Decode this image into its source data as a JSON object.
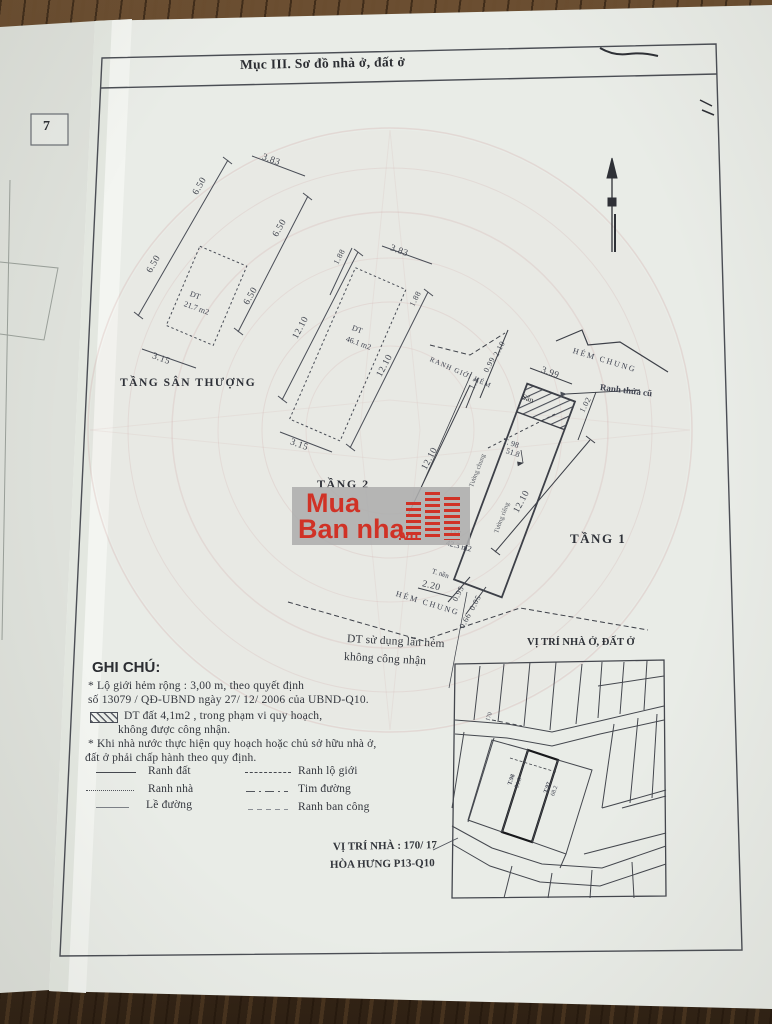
{
  "header": {
    "title": "Mục III. Sơ đồ nhà ở, đất ở"
  },
  "tab": {
    "label": "7"
  },
  "roof": {
    "name": "TẦNG SÂN THƯỢNG",
    "area_label": "DT",
    "area_value": "21.7 m2",
    "dims": {
      "top": "3.83",
      "bottom": "3.15",
      "side": "6.50"
    }
  },
  "floor2": {
    "name": "TẦNG 2",
    "area_label": "DT",
    "area_value": "46.1 m2",
    "dims": {
      "top": "3.83",
      "bottom": "3.15",
      "side": "12.10",
      "small": "1.88"
    }
  },
  "floor1": {
    "name": "TẦNG 1",
    "area_label": "DT",
    "area_value": "42.3 m2",
    "san": "Sân",
    "point_id": "T. 98",
    "point_area": "51.8",
    "dims": {
      "top": "3.99",
      "tl_a": "2.10",
      "tl_b": "0.99",
      "left_short": "1.3",
      "right_short": "1.02",
      "side": "12.10",
      "b_a": "2.20",
      "b_b": "0.95",
      "b_c": "0.05",
      "b_d": "0.66"
    },
    "labels": {
      "hem_chung_top": "HẺM CHUNG",
      "ranh_thua_cu": "Ranh thửa cũ",
      "ranh_gioi_hem": "RANH GIỚI HẺM",
      "tuong_chung": "Tường chung",
      "tuong_rieng": "Tường riêng",
      "t_nen": "T. nền",
      "hem_chung_bottom": "HẺM CHUNG",
      "note_line1": "DT sử dụng lấn hẻm",
      "note_line2": "không công nhận"
    }
  },
  "watermark": {
    "line1": "Mua",
    "line2": "Ban nha",
    "vn": ".vn"
  },
  "notes": {
    "title": "GHI CHÚ:",
    "lines": [
      "* Lộ giới hẻm rộng : 3,00 m, theo quyết định",
      "số 13079 / QĐ-UBND ngày 27/ 12/ 2006 của UBND-Q10.",
      "DT đất 4,1m2 , trong phạm vi quy hoạch,",
      "không được công nhận.",
      "* Khi nhà nước thực hiện quy hoạch hoặc chủ sở hữu nhà ở,",
      "đất ở phải chấp hành theo quy định."
    ]
  },
  "legend": {
    "items": [
      {
        "label": "Ranh đất"
      },
      {
        "label": "Ranh lộ giới"
      },
      {
        "label": "Ranh nhà"
      },
      {
        "label": "Tim đường"
      },
      {
        "label": "Lề đường"
      },
      {
        "label": "Ranh ban công"
      }
    ]
  },
  "map": {
    "title": "VỊ TRÍ NHÀ Ở, ĐẤT Ở",
    "street_no": "170",
    "p1_id": "T.98",
    "p1_area": "51.8",
    "p2_id": "T.97",
    "p2_area": "68.2"
  },
  "address": {
    "line1": "VỊ TRÍ NHÀ : 170/ 17",
    "line2": "HÒA HƯNG  P13-Q10"
  }
}
